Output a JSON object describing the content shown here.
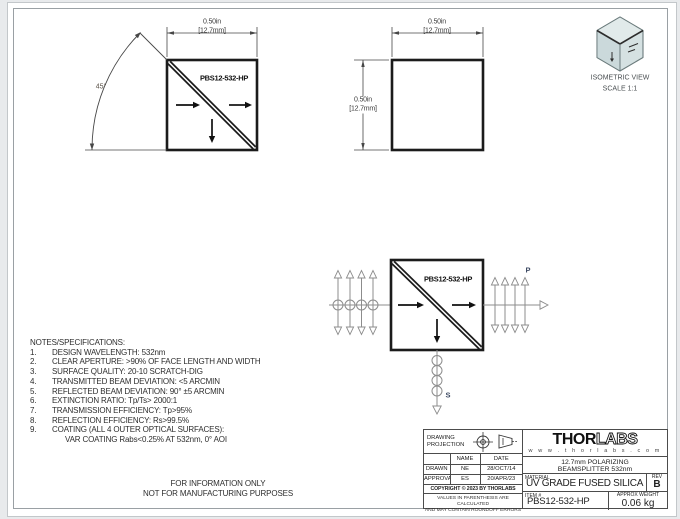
{
  "drawing": {
    "part_label": "PBS12-532-HP",
    "dim_in": "0.50in",
    "dim_mm": "[12.7mm]",
    "angle_label": "45°",
    "p_label": "P",
    "s_label": "S",
    "iso_title": "ISOMETRIC VIEW",
    "iso_scale": "SCALE 1:1"
  },
  "notes": {
    "title": "NOTES/SPECIFICATIONS:",
    "items": [
      {
        "num": "1.",
        "text": "DESIGN WAVELENGTH:  532nm"
      },
      {
        "num": "2.",
        "text": "CLEAR APERTURE: >90% OF FACE LENGTH AND WIDTH"
      },
      {
        "num": "3.",
        "text": "SURFACE QUALITY: 20-10 SCRATCH-DIG"
      },
      {
        "num": "4.",
        "text": "TRANSMITTED BEAM DEVIATION: <5 ARCMIN"
      },
      {
        "num": "5.",
        "text": "REFLECTED BEAM DEVIATION: 90° ±5 ARCMIN"
      },
      {
        "num": "6.",
        "text": "EXTINCTION RATIO: Tp/Ts> 2000:1"
      },
      {
        "num": "7.",
        "text": "TRANSMISSION EFFICIENCY: Tp>95%"
      },
      {
        "num": "8.",
        "text": "REFLECTION EFFICIENCY: Rs>99.5%"
      },
      {
        "num": "9.",
        "text": "COATING (ALL 4 OUTER OPTICAL SURFACES):"
      },
      {
        "num": "",
        "text": "VAR COATING Rabs<0.25% AT 532nm, 0° AOI"
      }
    ]
  },
  "info_only": {
    "line1": "FOR INFORMATION ONLY",
    "line2": "NOT FOR MANUFACTURING PURPOSES"
  },
  "title_block": {
    "projection_label": "DRAWING PROJECTION",
    "table": {
      "name_header": "NAME",
      "date_header": "DATE",
      "drawn_label": "DRAWN",
      "drawn_name": "NE",
      "drawn_date": "28/OCT/14",
      "approval_label": "APPROVAL",
      "approval_name": "ES",
      "approval_date": "20/APR/23"
    },
    "copyright": "COPYRIGHT © 2023 BY THORLABS",
    "disclaimer_line1": "VALUES IN PARENTHESIS ARE CALCULATED",
    "disclaimer_line2": "AND MAY CONTAIN ROUNDOFF ERRORS",
    "logo_thor": "THOR",
    "logo_labs": "LABS",
    "website": "w w w . t h o r l a b s . c o m",
    "description_line1": "12.7mm POLARIZING",
    "description_line2": "BEAMSPLITTER 532nm",
    "material_label": "MATERIAL",
    "material": "UV GRADE FUSED SILICA",
    "rev_label": "REV",
    "rev": "B",
    "item_label": "ITEM #",
    "item": "PBS12-532-HP",
    "weight_label": "APPROX WEIGHT",
    "weight": "0.06 kg"
  },
  "colors": {
    "line_dark": "#1b1b1b",
    "dim_line": "#474747",
    "beam_gray": "#8c8c8c",
    "iso_face": "#d5e1e2"
  }
}
